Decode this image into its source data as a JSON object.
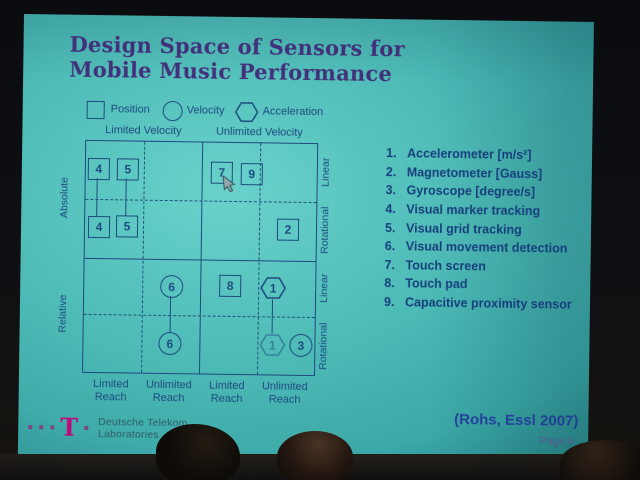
{
  "colors": {
    "slide_teal": "#4dbab6",
    "diagram_navy": "#1c4a80",
    "title_purple": "#42307a",
    "citation_blue": "#23419a",
    "telekom_magenta": "#bf0a7e",
    "page_muted": "#5b5f9b",
    "logo_text": "#2e5d64"
  },
  "slide": {
    "title": {
      "line1": "Design Space of Sensors for",
      "line2": "Mobile Music Performance"
    },
    "legend": {
      "items": [
        {
          "shape": "square",
          "label": "Position"
        },
        {
          "shape": "circle",
          "label": "Velocity"
        },
        {
          "shape": "hexagon",
          "label": "Acceleration"
        }
      ]
    },
    "diagram": {
      "column_headers": [
        "Limited Velocity",
        "Unlimited Velocity"
      ],
      "row_labels_left": [
        "Absolute",
        "Relative"
      ],
      "row_labels_right": [
        "Linear",
        "Rotational",
        "Linear",
        "Rotational"
      ],
      "reach_labels": [
        {
          "l1": "Limited",
          "l2": "Reach"
        },
        {
          "l1": "Unlimited",
          "l2": "Reach"
        },
        {
          "l1": "Limited",
          "l2": "Reach"
        },
        {
          "l1": "Unlimited",
          "l2": "Reach"
        }
      ],
      "items": [
        {
          "shape": "square",
          "label": "4",
          "cell": "absolute / linear / limited velocity / limited reach"
        },
        {
          "shape": "square",
          "label": "5",
          "cell": "absolute / linear / limited velocity / limited reach"
        },
        {
          "shape": "square",
          "label": "7",
          "cell": "absolute / linear / unlimited velocity / limited reach"
        },
        {
          "shape": "square",
          "label": "9",
          "cell": "absolute / linear / unlimited velocity / limited reach"
        },
        {
          "shape": "square",
          "label": "4",
          "cell": "absolute / rotational / limited velocity / limited reach"
        },
        {
          "shape": "square",
          "label": "5",
          "cell": "absolute / rotational / limited velocity / limited reach"
        },
        {
          "shape": "square",
          "label": "2",
          "cell": "absolute / rotational / unlimited velocity / unlimited reach"
        },
        {
          "shape": "circle",
          "label": "6",
          "cell": "relative / linear / limited velocity / unlimited reach"
        },
        {
          "shape": "square",
          "label": "8",
          "cell": "relative / linear / unlimited velocity / limited reach"
        },
        {
          "shape": "hexagon",
          "label": "1",
          "cell": "relative / linear / unlimited velocity / unlimited reach"
        },
        {
          "shape": "circle",
          "label": "6",
          "cell": "relative / rotational / limited velocity / unlimited reach"
        },
        {
          "shape": "hexagon",
          "label": "1",
          "cell": "relative / rotational / unlimited velocity / unlimited reach"
        },
        {
          "shape": "circle",
          "label": "3",
          "cell": "relative / rotational / unlimited velocity / unlimited reach"
        }
      ]
    },
    "sensor_list": [
      {
        "num": "1.",
        "label": "Accelerometer [m/s²]"
      },
      {
        "num": "2.",
        "label": "Magnetometer [Gauss]"
      },
      {
        "num": "3.",
        "label": "Gyroscope [degree/s]"
      },
      {
        "num": "4.",
        "label": "Visual marker tracking"
      },
      {
        "num": "5.",
        "label": "Visual grid tracking"
      },
      {
        "num": "6.",
        "label": "Visual movement detection"
      },
      {
        "num": "7.",
        "label": "Touch screen"
      },
      {
        "num": "8.",
        "label": "Touch pad"
      },
      {
        "num": "9.",
        "label": "Capacitive proximity sensor"
      }
    ],
    "citation": "(Rohs, Essl 2007)",
    "page_label": "Page 6",
    "logo": {
      "letter": "T",
      "line1": "Deutsche Telekom",
      "line2": "Laboratories"
    }
  }
}
